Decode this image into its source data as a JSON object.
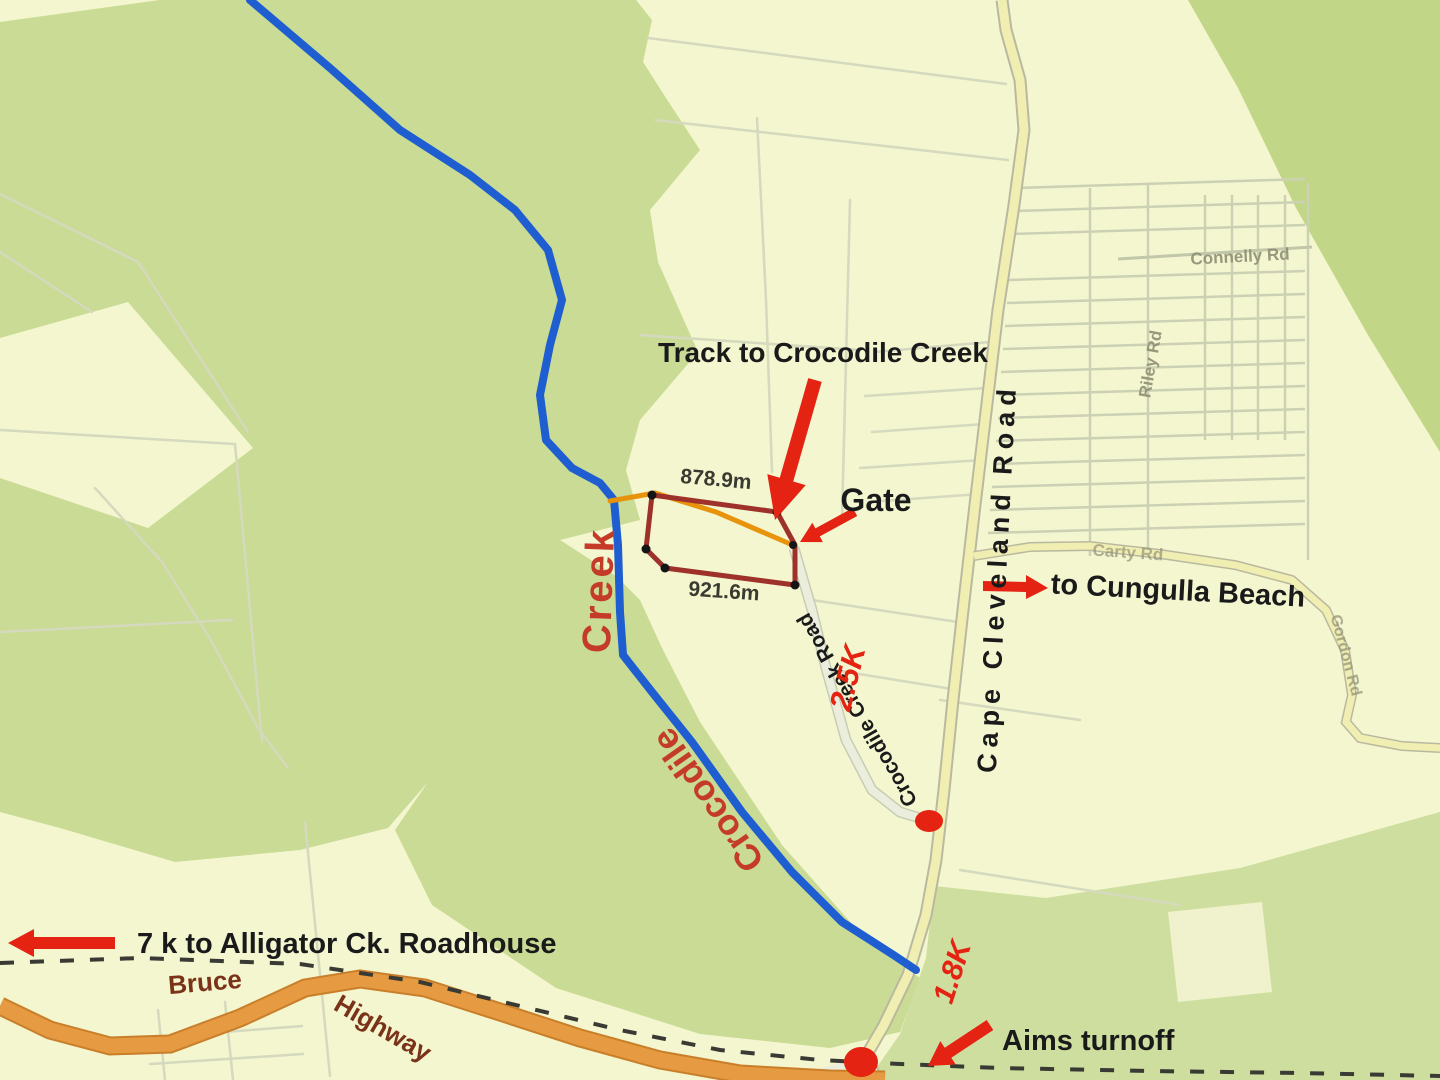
{
  "map": {
    "annotations": {
      "track_label": "Track to Crocodile Creek",
      "gate_label": "Gate",
      "cungulla_label": "to Cungulla Beach",
      "roadhouse_label": "7 k to Alligator Ck. Roadhouse",
      "aims_label": "Aims turnoff",
      "distance_to_gate": "2.5K",
      "distance_to_turnoff": "1.8K",
      "boundary_top_length": "878.9m",
      "boundary_bottom_length": "921.6m"
    },
    "creek": {
      "name_word1": "Crocodile",
      "name_word2": "Creek"
    },
    "roads": {
      "cape_cleveland": "Cape Cleveland Road",
      "crocodile_creek_road": "Crocodile Creek Road",
      "bruce_word1": "Bruce",
      "bruce_word2": "Highway",
      "connelly": "Connelly Rd",
      "riley": "Riley Rd",
      "carty": "Carty Rd",
      "gordon": "Gordon Rd"
    },
    "colors": {
      "background": "#f3f6cf",
      "vegetation": "#c9db94",
      "vegetation_bottom": "#cede9f",
      "creek_blue": "#1e5ed0",
      "highway_orange": "#e69a41",
      "highway_casing": "#c97f2a",
      "road_yellow": "#f1eeb2",
      "road_casing": "#b9b9a0",
      "minor_road_pale": "#ecEEdd",
      "boundary_red": "#9e322b",
      "track_orange": "#e8930c",
      "annotation_red": "#e42313",
      "creek_label_red": "#c43b28",
      "highway_label_brown": "#7a3318",
      "road_name_grey": "#8e8e74",
      "label_black": "#1a1a1a",
      "cadastral_grey": "#d5d9bd"
    }
  }
}
